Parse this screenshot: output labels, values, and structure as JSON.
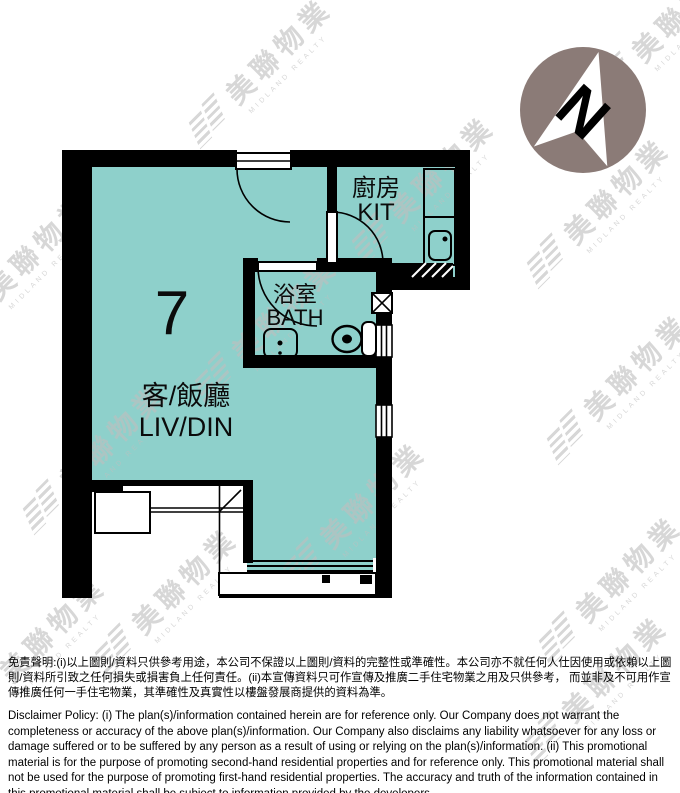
{
  "plan": {
    "unit_number": "7",
    "compass_label": "N",
    "rooms": {
      "kitchen": {
        "zh": "廚房",
        "en": "KIT"
      },
      "bathroom": {
        "zh": "浴室",
        "en": "BATH"
      },
      "living_dining": {
        "zh": "客/飯廳",
        "en": "LIV/DIN"
      }
    },
    "colors": {
      "room_fill": "#8ed0cb",
      "wall": "#000000",
      "compass_circle": "#8b7b77",
      "watermark": "#bfbfbf"
    }
  },
  "watermark": {
    "zh": "美聯物業",
    "en": "MIDLAND REALTY"
  },
  "disclaimer": {
    "zh": "免責聲明:(i)以上圖則/資料只供參考用途，本公司不保證以上圖則/資料的完整性或準確性。本公司亦不就任何人仕因使用或依賴以上圖則/資料所引致之任何損失或損害負上任何責任。(ii)本宣傳資料只可作宣傳及推廣二手住宅物業之用及只供參考， 而並非及不可用作宣傳推廣任何一手住宅物業，其準確性及真實性以樓盤發展商提供的資料為準。",
    "en": "Disclaimer Policy: (i) The plan(s)/information contained herein are for reference only. Our Company does not warrant the completeness or accuracy of the above plan(s)/information. Our Company also disclaims any liability whatsoever for any loss or damage suffered or to be suffered by any person as a result of using or relying on the plan(s)/information. (ii) This promotional material is for the purpose of promoting second-hand residential properties and for reference only. This promotional material shall not be used for the purpose of promoting first-hand residential properties. The accuracy and truth of the information contained in this promotional material shall be subject to information provided by the developers."
  }
}
